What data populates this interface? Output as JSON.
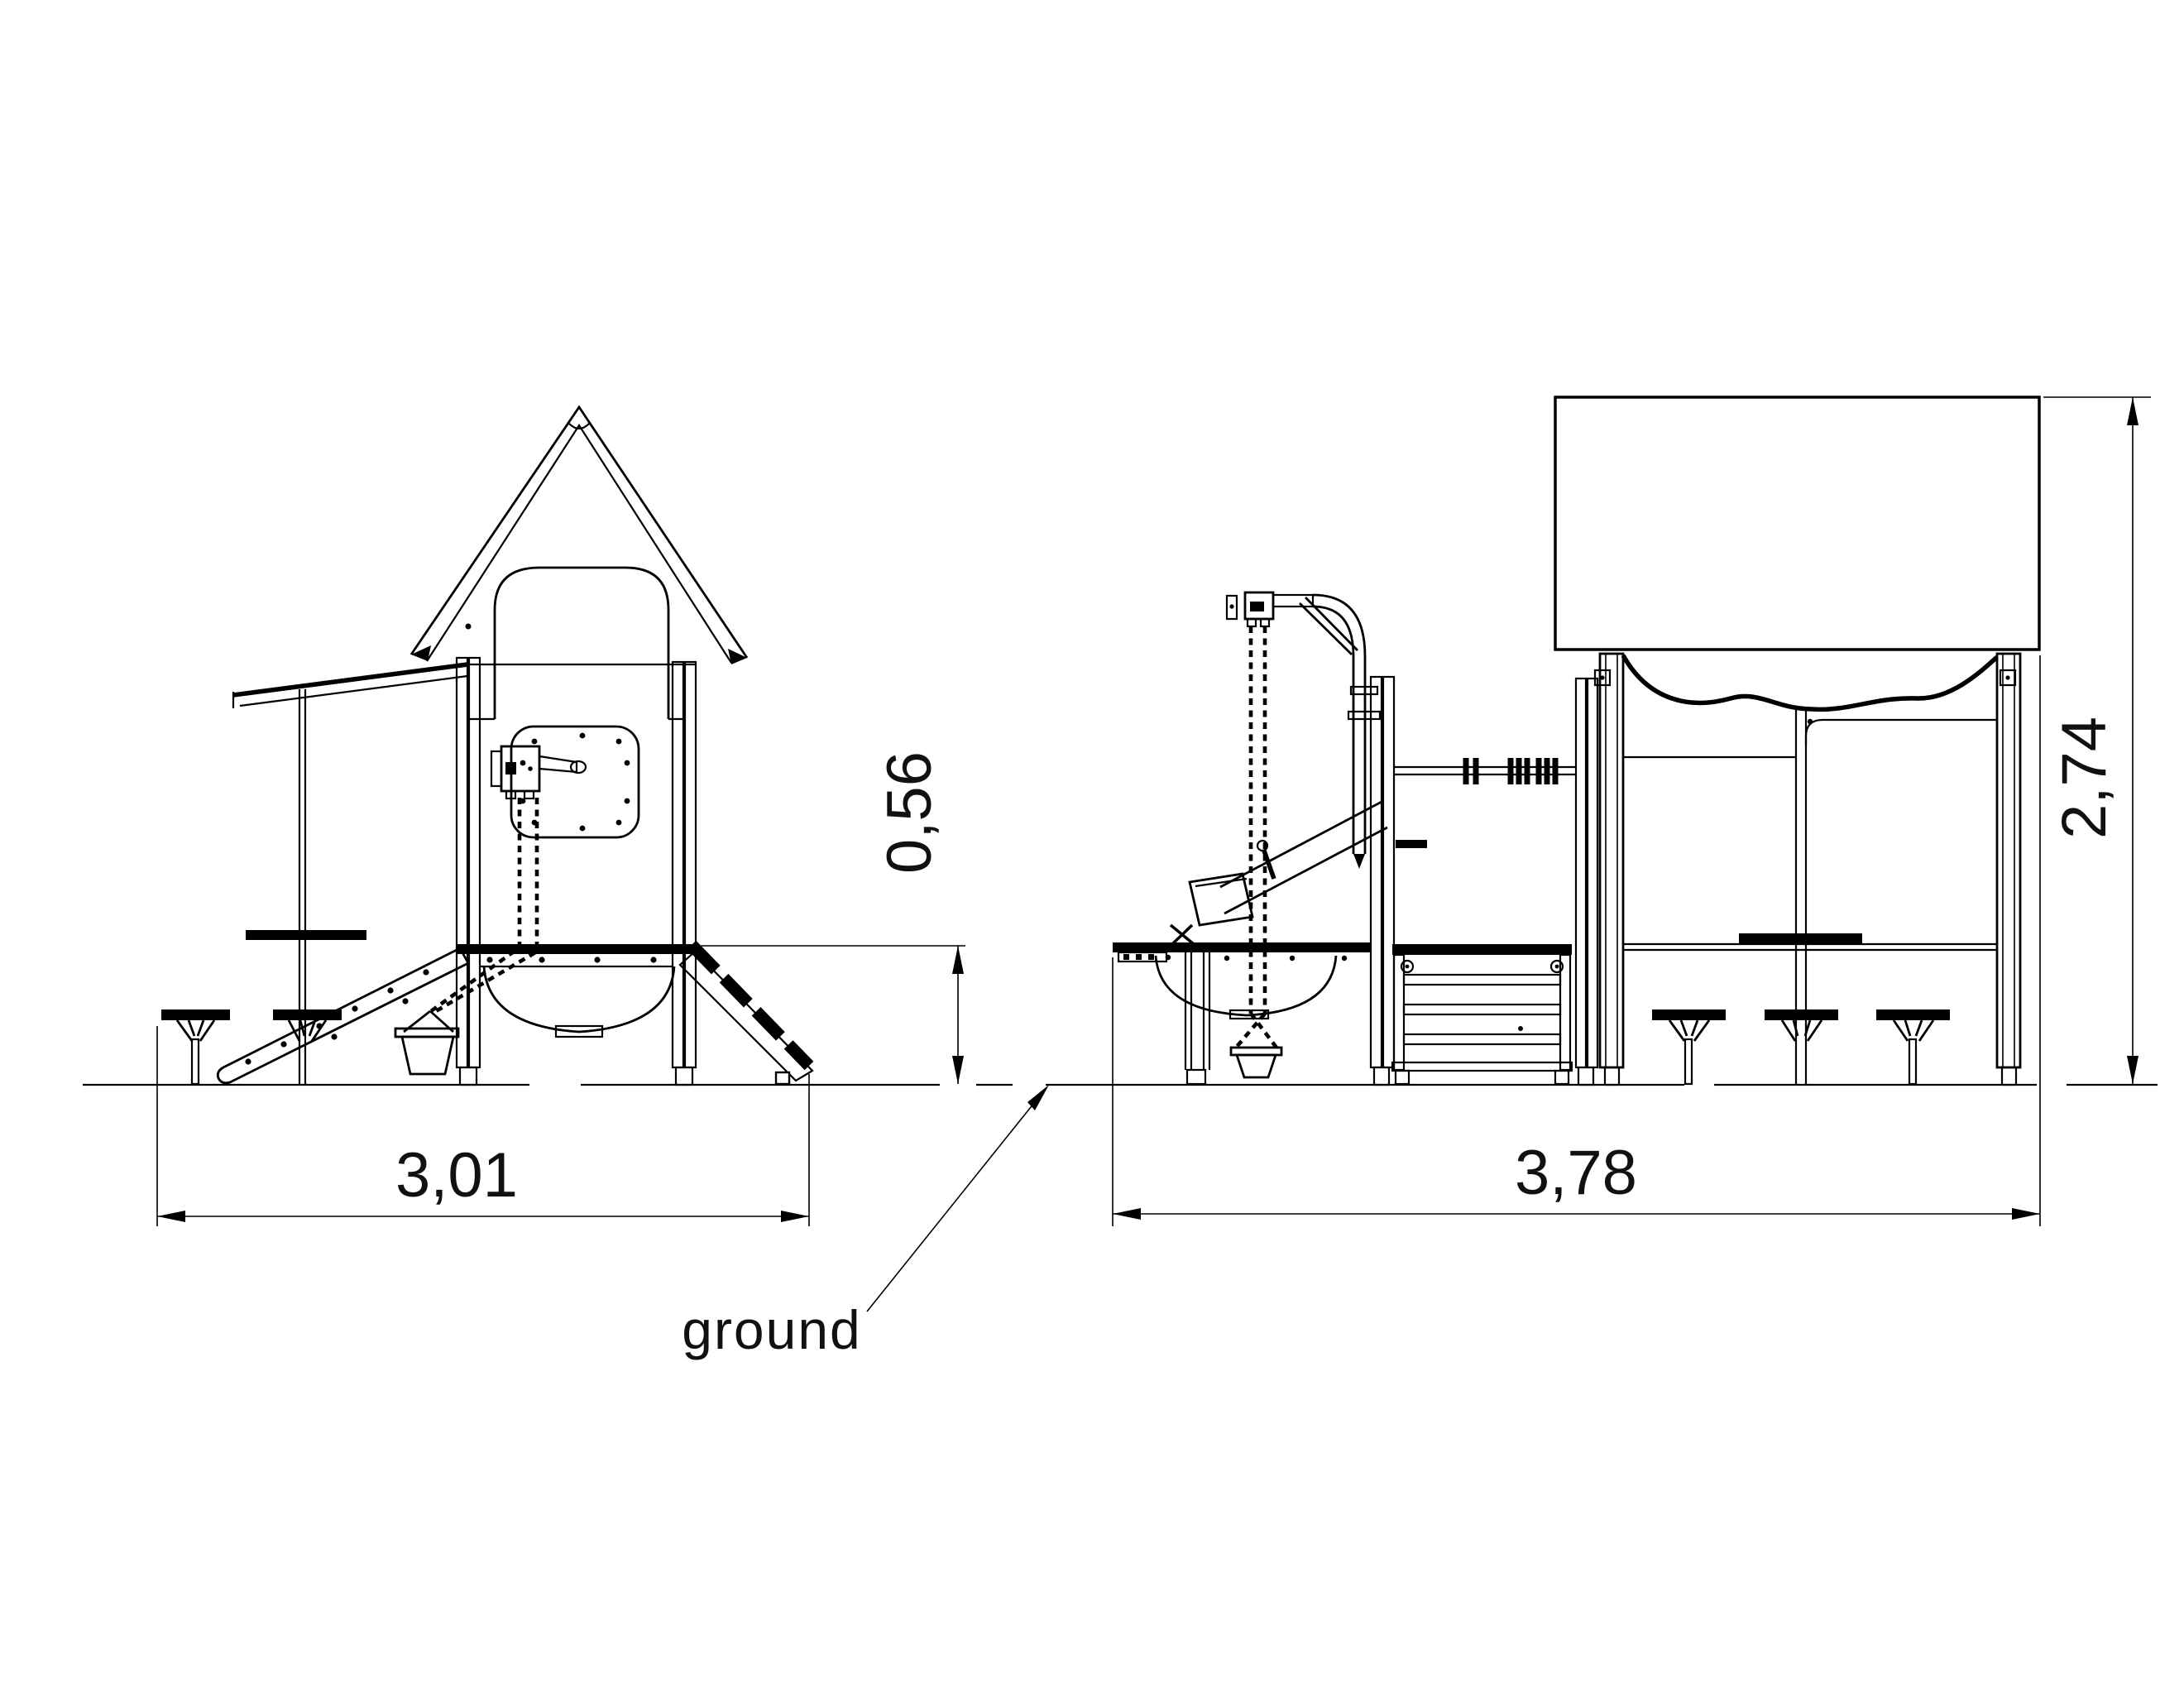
{
  "drawing": {
    "background_color": "#ffffff",
    "line_color": "#000000",
    "views": {
      "left_view": "play tower side elevation",
      "right_view": "play structure side elevation"
    },
    "dimensions": {
      "left_width": "3,01",
      "platform_height": "0,56",
      "right_width": "3,78",
      "overall_height": "2,74"
    },
    "labels": {
      "ground": "ground"
    }
  }
}
